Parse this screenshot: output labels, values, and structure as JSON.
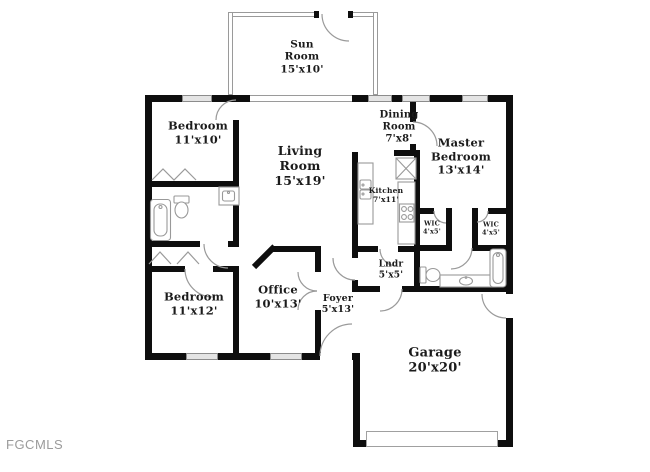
{
  "watermark": "FGCMLS",
  "colors": {
    "wall": "#0e0e0e",
    "fixture_stroke": "#999999",
    "window_fill": "#e4e4e4",
    "label_text": "#1b1b1b",
    "watermark_text": "#9b9b9b",
    "background": "#ffffff"
  },
  "rooms": [
    {
      "id": "sun-room",
      "name": "Sun Room",
      "dims": "15'x10'",
      "label": "Sun\nRoom\n15'x10'"
    },
    {
      "id": "bedroom-1",
      "name": "Bedroom",
      "dims": "11'x10'",
      "label": "Bedroom\n11'x10'"
    },
    {
      "id": "living-room",
      "name": "Living Room",
      "dims": "15'x19'",
      "label": "Living\nRoom\n15'x19'"
    },
    {
      "id": "dining-room",
      "name": "Dining Room",
      "dims": "7'x8'",
      "label": "Dining\nRoom\n7'x8'"
    },
    {
      "id": "master-bedroom",
      "name": "Master Bedroom",
      "dims": "13'x14'",
      "label": "Master\nBedroom\n13'x14'"
    },
    {
      "id": "kitchen",
      "name": "Kitchen",
      "dims": "7'x11'",
      "label": "Kitchen\n7'x11'"
    },
    {
      "id": "wic-1",
      "name": "WIC",
      "dims": "4'x5'",
      "label": "WIC\n4'x5'"
    },
    {
      "id": "wic-2",
      "name": "WIC",
      "dims": "4'x5'",
      "label": "WIC\n4'x5'"
    },
    {
      "id": "laundry",
      "name": "Lndr",
      "dims": "5'x5'",
      "label": "Lndr\n5'x5'"
    },
    {
      "id": "bedroom-2",
      "name": "Bedroom",
      "dims": "11'x12'",
      "label": "Bedroom\n11'x12'"
    },
    {
      "id": "office",
      "name": "Office",
      "dims": "10'x13'",
      "label": "Office\n10'x13'"
    },
    {
      "id": "foyer",
      "name": "Foyer",
      "dims": "5'x13'",
      "label": "Foyer\n5'x13'"
    },
    {
      "id": "garage",
      "name": "Garage",
      "dims": "20'x20'",
      "label": "Garage\n20'x20'"
    }
  ]
}
